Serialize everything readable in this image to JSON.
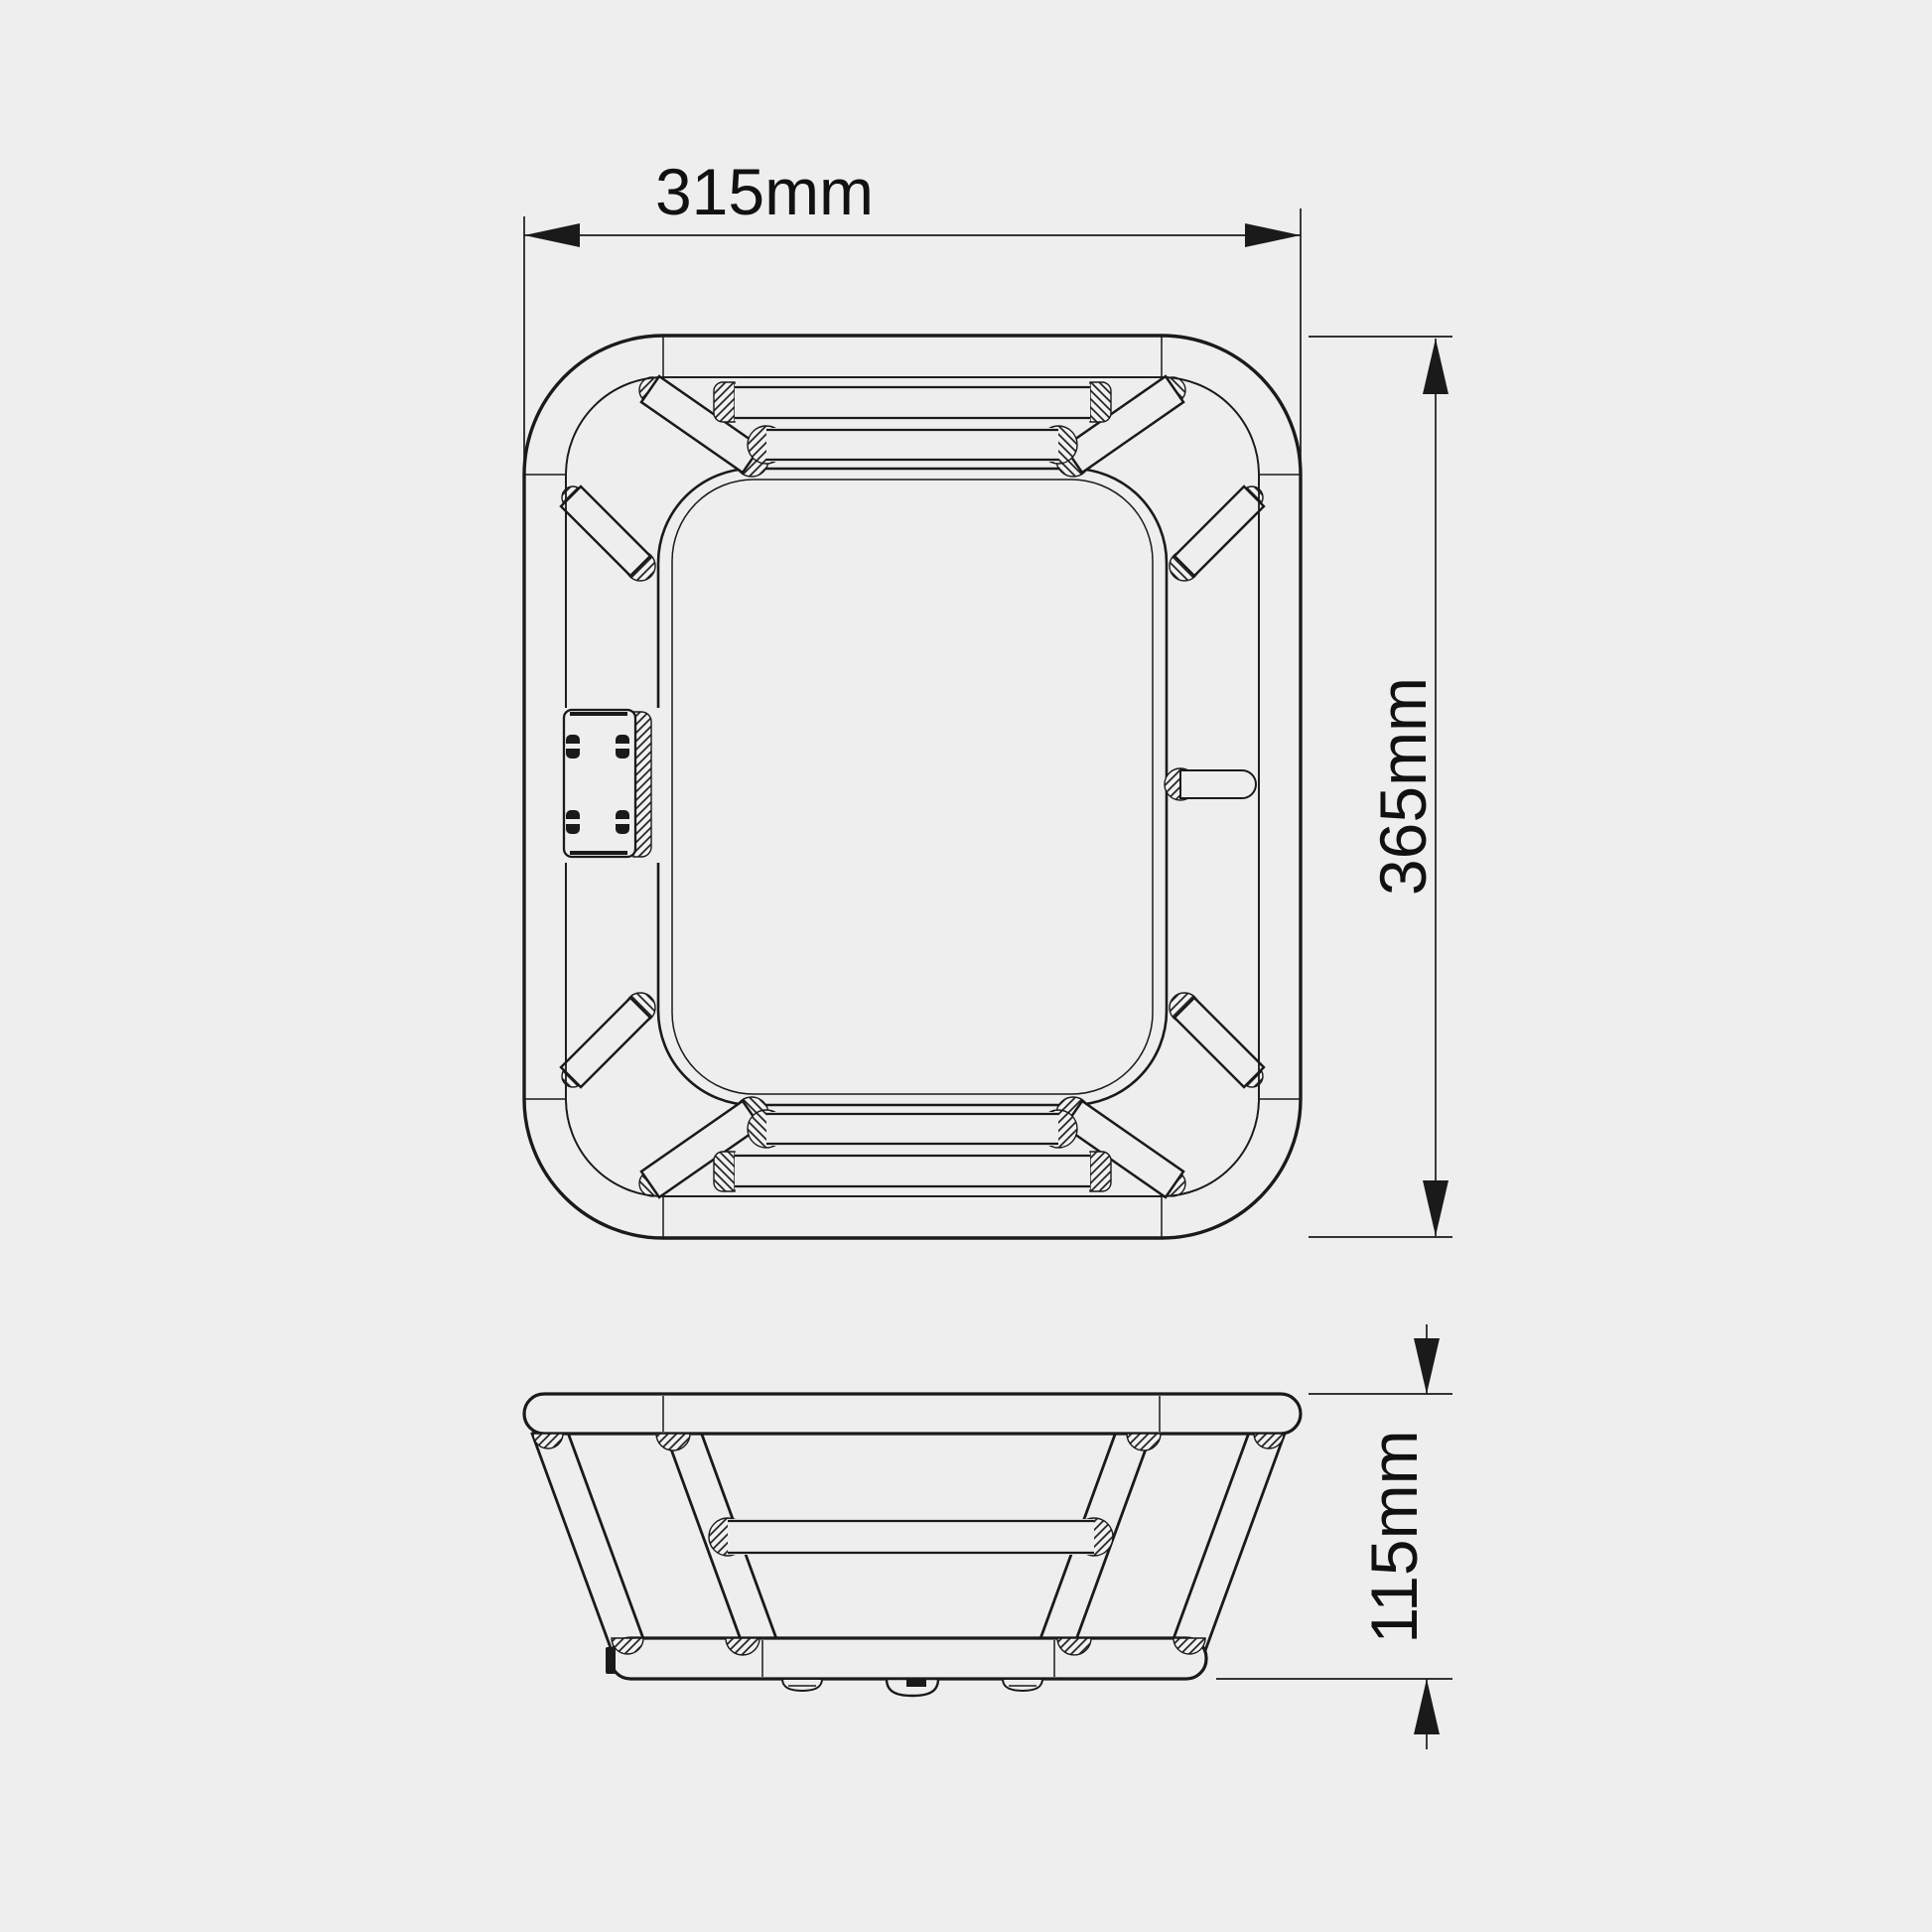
{
  "canvas": {
    "background": "#eeeeef",
    "line_color": "#1a1a1a",
    "text_color": "#111111"
  },
  "drawing": {
    "type": "orthographic-technical-drawing",
    "dimensions": {
      "width": {
        "value": 315,
        "unit": "mm",
        "label": "315mm"
      },
      "height": {
        "value": 365,
        "unit": "mm",
        "label": "365mm"
      },
      "depth": {
        "value": 115,
        "unit": "mm",
        "label": "115mm"
      }
    }
  }
}
